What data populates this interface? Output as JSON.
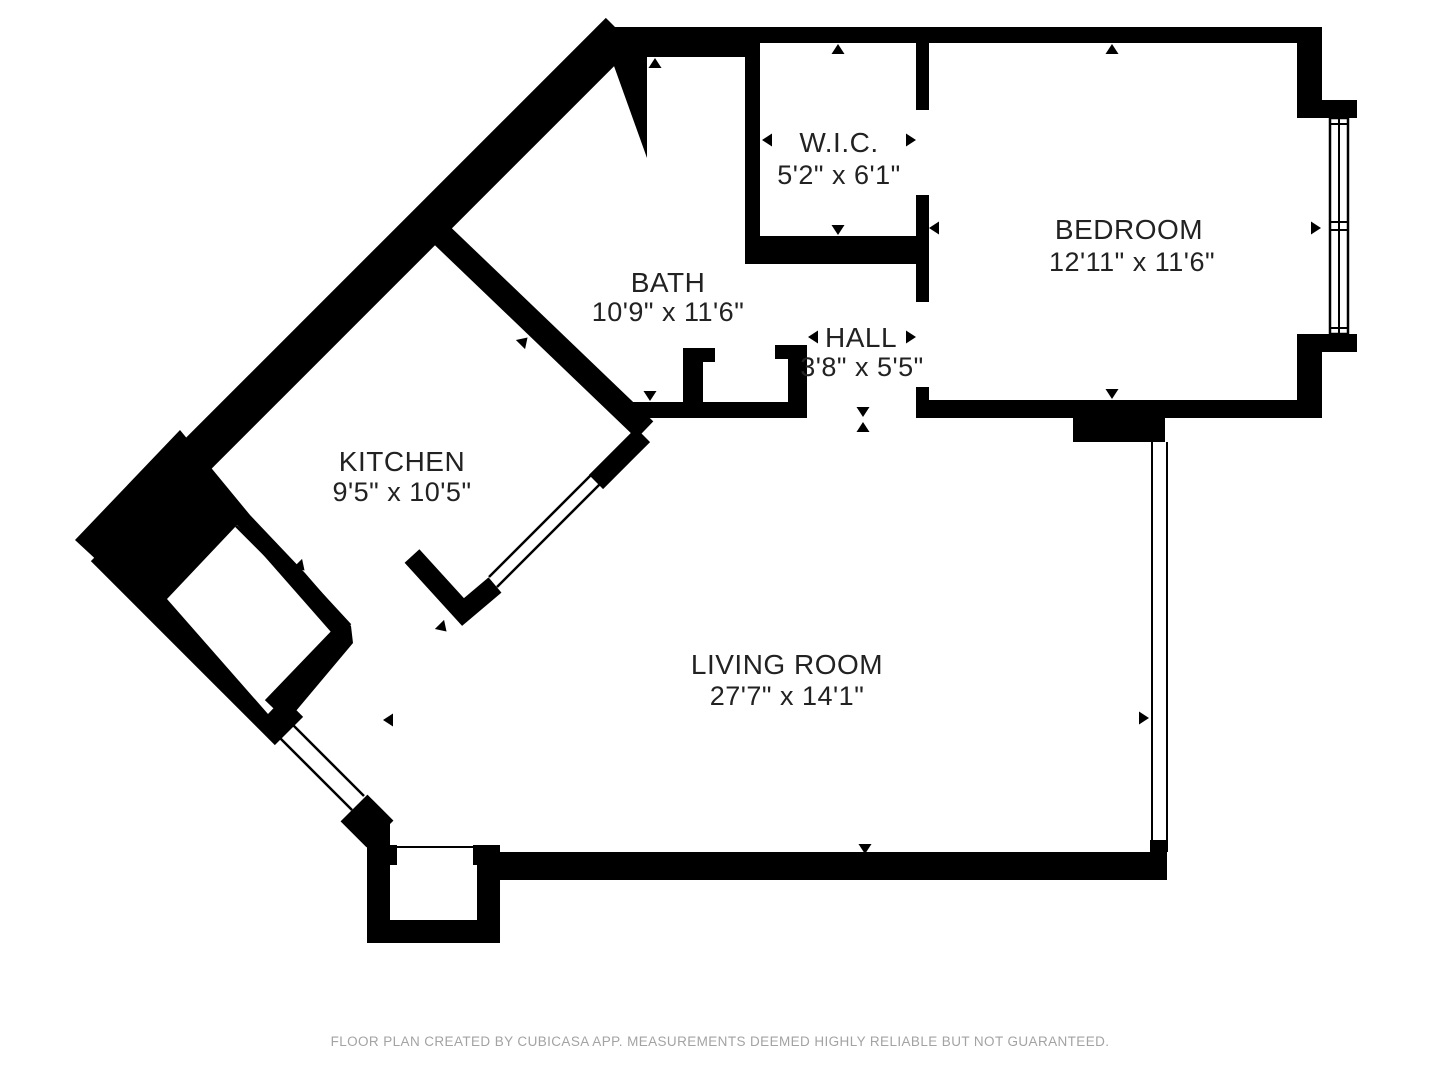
{
  "floor_plan": {
    "wall_color": "#000000",
    "background_color": "#ffffff",
    "label_color": "#222222",
    "footer": "FLOOR PLAN CREATED BY CUBICASA APP. MEASUREMENTS DEEMED HIGHLY RELIABLE BUT NOT GUARANTEED.",
    "footer_color": "#a3a3a3",
    "rooms": {
      "wic": {
        "name": "W.I.C.",
        "dimensions": "5'2\" x 6'1\""
      },
      "bath": {
        "name": "BATH",
        "dimensions": "10'9\" x 11'6\""
      },
      "hall": {
        "name": "HALL",
        "dimensions": "3'8\" x 5'5\""
      },
      "bedroom": {
        "name": "BEDROOM",
        "dimensions": "12'11\" x 11'6\""
      },
      "kitchen": {
        "name": "KITCHEN",
        "dimensions": "9'5\" x 10'5\""
      },
      "living_room": {
        "name": "LIVING ROOM",
        "dimensions": "27'7\" x 14'1\""
      }
    }
  }
}
